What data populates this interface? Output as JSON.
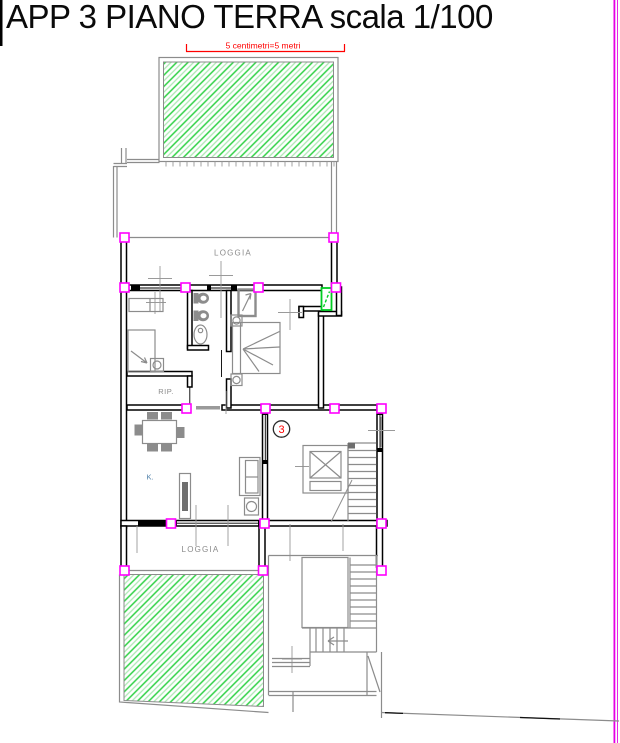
{
  "title": "APP 3 PIANO TERRA scala 1/100",
  "scale_bar": {
    "label": "5 centimetri=5 metri"
  },
  "rooms": {
    "loggia_upper": "LOGGIA",
    "loggia_lower": "LOGGIA",
    "storage": "RIP.",
    "kitchen": "K."
  },
  "unit_badge": {
    "number": "3"
  },
  "colors": {
    "wall": "#000000",
    "outline-gray": "#8c8c8c",
    "hatch-green": "#2fd144",
    "hatch-green-light": "#aee8b4",
    "magenta": "#ff00ff",
    "boundary-magenta": "#e400e4",
    "red": "#ff0000",
    "label-gray": "#8a8a8a",
    "kitchen-blue": "#4d7fa8",
    "door-green": "#00cc22"
  }
}
